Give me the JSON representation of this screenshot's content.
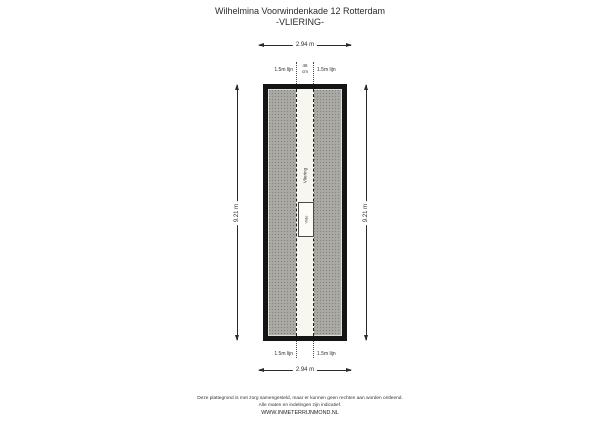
{
  "title": {
    "line1": "Wilhelmina Voorwindenkade 12 Rotterdam",
    "line2": "-VLIERING-"
  },
  "plan": {
    "room_label": "Vliering",
    "vide_label": "Vide",
    "dimensions": {
      "width_top": "2.94 m",
      "width_bottom": "2.94 m",
      "height_left": "9.21 m",
      "height_right": "9.21 m"
    },
    "annotations": {
      "top_left_line": "1.5m lijn",
      "top_right_line": "1.5m lijn",
      "strip_width_value": "46",
      "strip_width_unit": "cm",
      "bottom_left_line": "1.5m lijn",
      "bottom_right_line": "1.5m lijn"
    },
    "colors": {
      "wall": "#141414",
      "roof_surface": "#aba9a4",
      "walkway_strip": "#f7f6ef"
    }
  },
  "footer": {
    "disclaimer_line1": "Deze plattegrond is met zorg samengesteld, maar er kunnen geen rechten aan worden ontleend.",
    "disclaimer_line2": "Alle maten en indelingen zijn indicatief.",
    "website": "WWW.INMETERRIJNMOND.NL"
  }
}
